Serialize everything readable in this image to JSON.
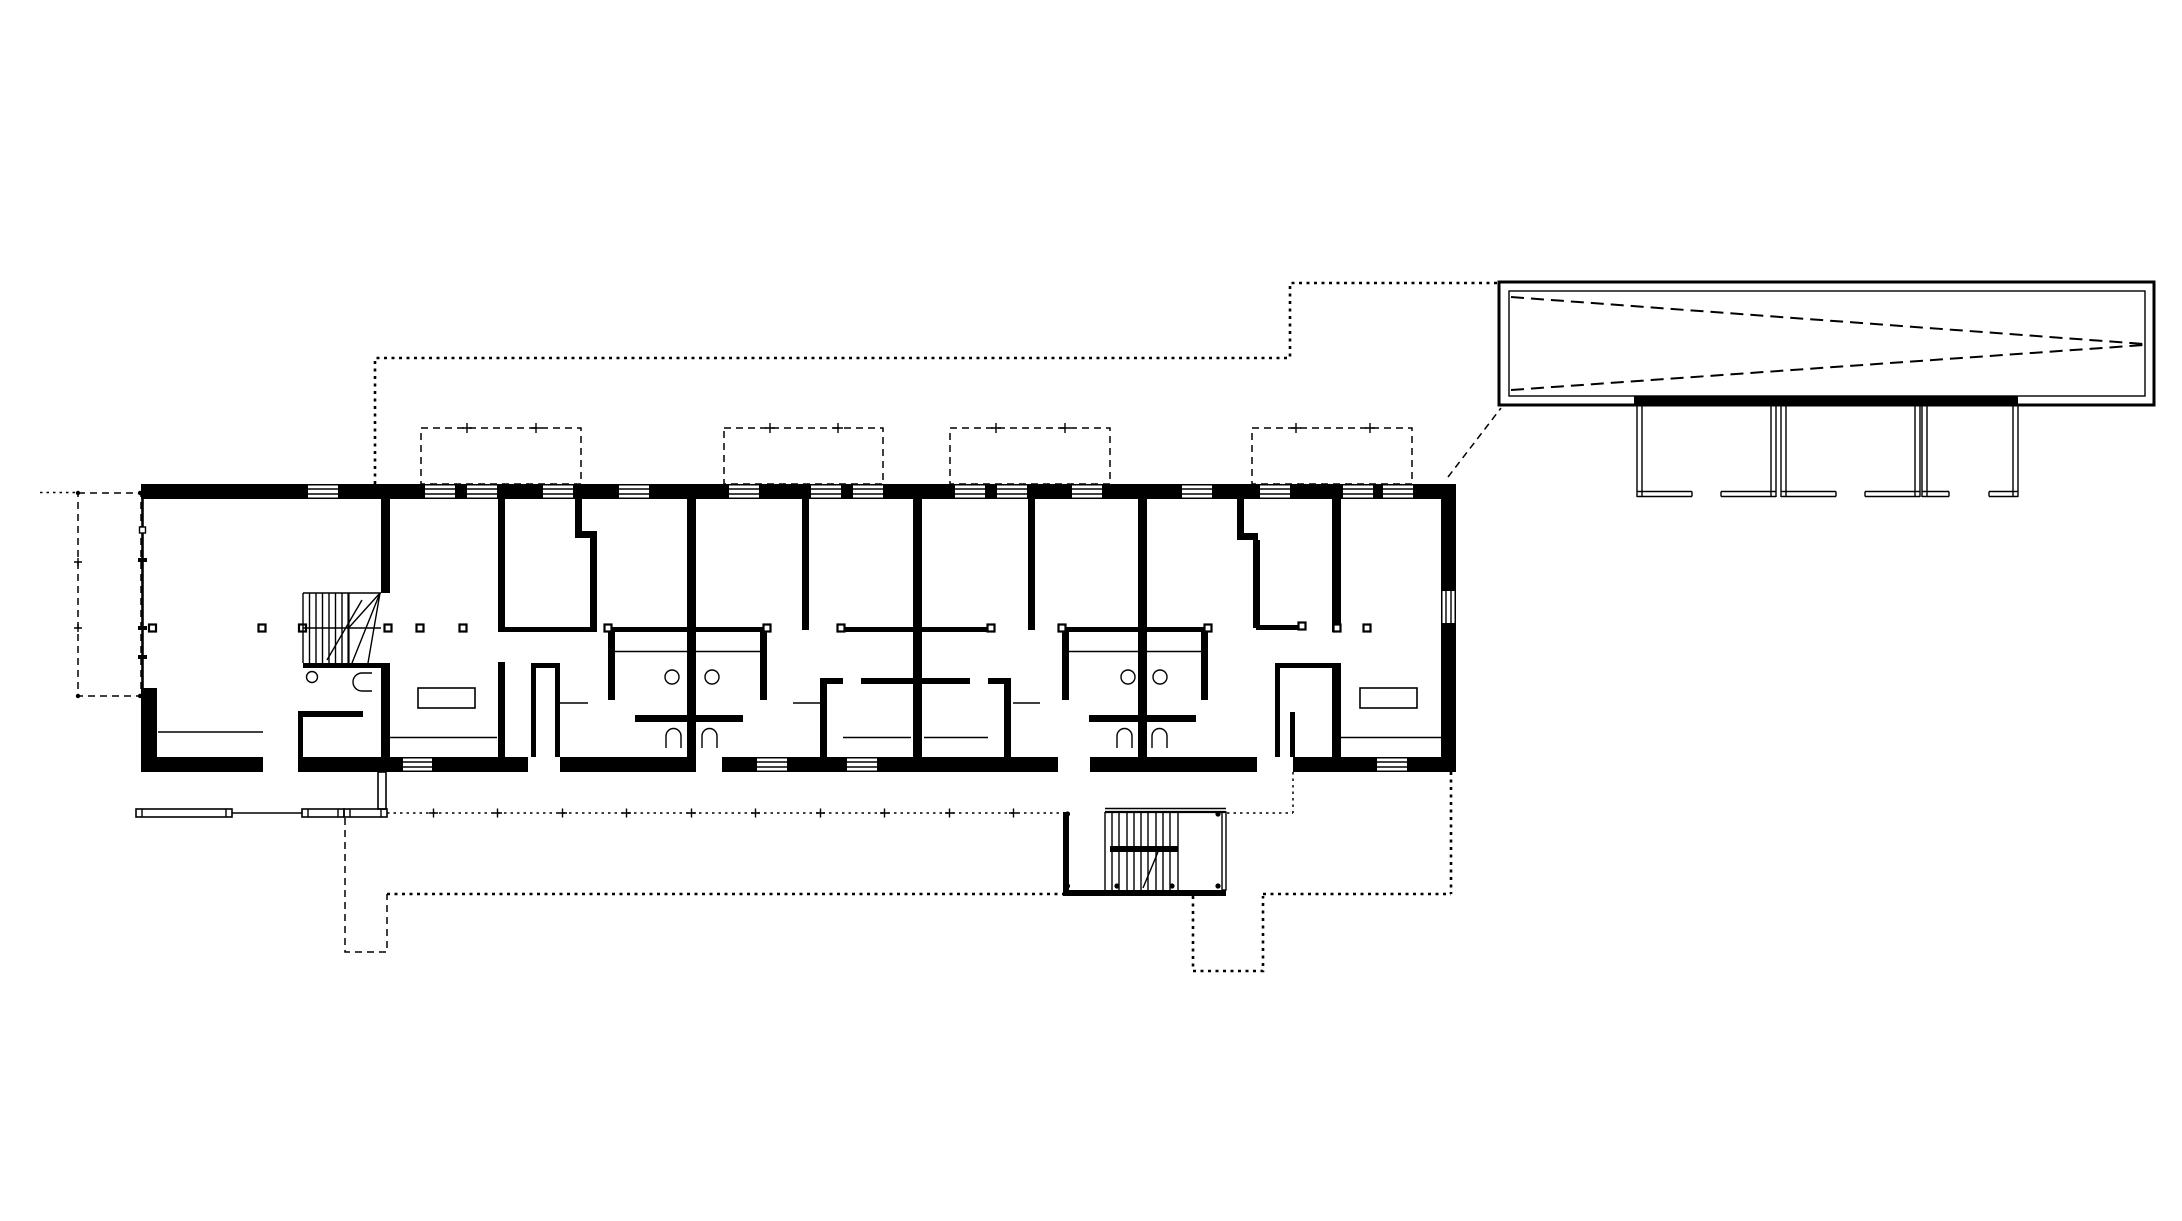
{
  "document": {
    "kind": "architectural floor plan drawing",
    "visible_text": [],
    "sheet": {
      "width_px": 2182,
      "height_px": 1221
    }
  },
  "colors": {
    "background": "#ffffff",
    "ink": "#000000"
  },
  "drawing": {
    "main_building": {
      "description": "long rectangular plan, thick poché walls, six bays",
      "elements": [
        "perimeter-walls",
        "window-openings",
        "unit-separating-walls",
        "interior-partitions",
        "bathroom-pairs",
        "entry-closets",
        "winder-stair",
        "wc-room",
        "tables",
        "column-markers"
      ]
    },
    "annotations": {
      "dashed_outlines": [
        "roof-overhang-outline",
        "skylight-dormer-outlines",
        "terrace-outline-left",
        "ground-line-with-ticks",
        "site-boundary-dotted",
        "projection-line-to-detail"
      ],
      "detail_top_right": "roof plan detail with tapered dashed wedge and three stall partitions",
      "exterior": [
        "external-stair",
        "benches",
        "connector"
      ]
    }
  }
}
